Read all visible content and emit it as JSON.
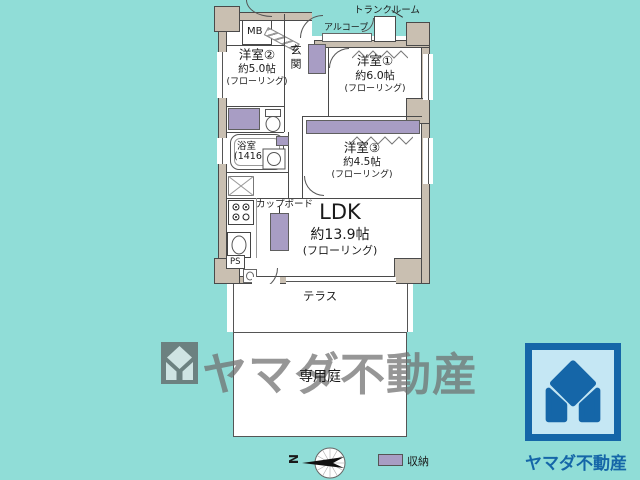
{
  "colors": {
    "background": "#90DDD7",
    "wall": "#C9BFB1",
    "storage": "#A89DC4",
    "outline": "#4a4a4a",
    "brand_blue": "#1566A8",
    "brand_light_blue": "#C5E7F4",
    "watermark_gray": "#6F6F6F"
  },
  "plan": {
    "trunk_room": "トランクルーム",
    "alcove": "アルコープ",
    "mb": "MB",
    "entrance": "玄関",
    "ps": "PS",
    "cupboard": "カップボード",
    "terrace": "テラス",
    "garden": "専用庭",
    "rooms": {
      "room2": {
        "name": "洋室②",
        "size": "約5.0帖",
        "floor": "(フローリング)"
      },
      "room1": {
        "name": "洋室①",
        "size": "約6.0帖",
        "floor": "(フローリング)"
      },
      "room3": {
        "name": "洋室③",
        "size": "約4.5帖",
        "floor": "(フローリング)"
      },
      "ldk": {
        "name": "LDK",
        "size": "約13.9帖",
        "floor": "(フローリング)"
      },
      "bath": {
        "name": "浴室",
        "size": "(1416)"
      }
    }
  },
  "legend": {
    "storage_label": "収納",
    "compass_letter": "N"
  },
  "watermark": {
    "text": "ヤマダ不動産"
  },
  "brand": {
    "text": "ヤマダ不動産"
  }
}
